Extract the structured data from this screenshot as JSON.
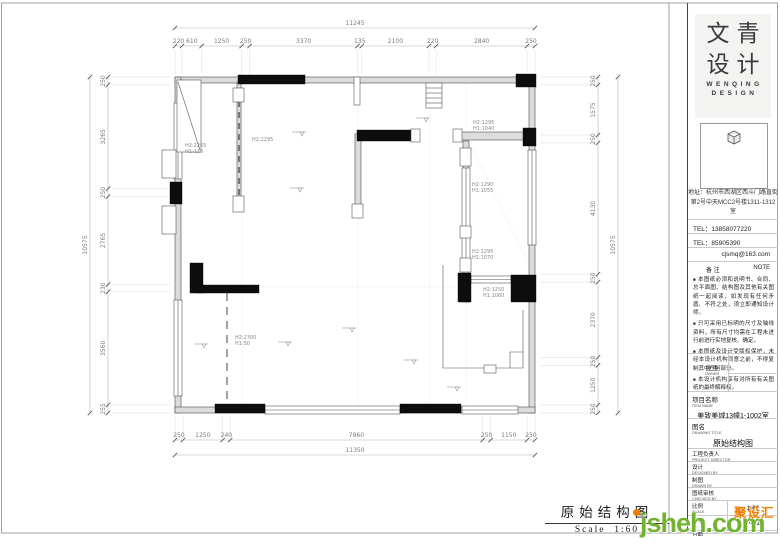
{
  "logo": {
    "line1": "文青",
    "line2": "设计",
    "sub1": "WENQING",
    "sub2": "DESIGN"
  },
  "contact": {
    "address_line1": "地址：杭州市西湖区西斗门路直街",
    "address_line2": "第2号中天MCC2号楼1311-1312室",
    "tel1": "TEL：13858077220",
    "tel2": "TEL：85905390",
    "email": "cjsmq@163.com"
  },
  "note": {
    "label": "备  注",
    "label_en": "NOTE",
    "items": [
      "本图纸必须和说明书、合同、总平面图、结构图及其他有关图纸一起阅读，如发现有任何矛盾、不符之处，须立即通知设计师。",
      "只可采用已标明的尺寸及轴线资料，所有尺寸均需在工程未进行前进行实地复核、确定。",
      "本图纸及设计受版权保护，未经本设计机构同意之前，不得复制其中任何部分。",
      "本设计机构享有对所有有关图纸的最终解释权。"
    ]
  },
  "fields": {
    "owner": {
      "label": "业主",
      "label_en": "OWNER"
    },
    "project": {
      "label": "项目名称",
      "label_en": "ITEM NAME",
      "value": "美致美城13幢1-1002室"
    },
    "drawing": {
      "label": "图名",
      "label_en": "DRAWING TITLE",
      "value": "原始结构图"
    },
    "director": {
      "label": "工程负责人",
      "label_en": "PROJECT DIRECTOR"
    },
    "design": {
      "label": "设计",
      "label_en": "DESIGNED BY"
    },
    "draft": {
      "label": "制图",
      "label_en": "DRAWN BY"
    },
    "check": {
      "label": "图纸审核",
      "label_en": "CHECKED BY"
    },
    "scale": {
      "label": "比例",
      "label_en": "SCALE",
      "value": "1:60"
    },
    "number": {
      "label": "图号",
      "label_en": "No.",
      "value": "P-01"
    },
    "date": {
      "label": "日期",
      "label_en": "DATE"
    }
  },
  "title_block": {
    "title": "原始结构图",
    "scale": "Scale  1:60"
  },
  "watermark": {
    "site": "jsheh.com",
    "brand": "聚设汇",
    "green": "#72b32f",
    "orange": "#f07d00"
  },
  "plan": {
    "dims_top_overall": "11245",
    "dims_top": [
      "220",
      "610",
      "1250",
      "250",
      "3370",
      "135",
      "2100",
      "220",
      "2840",
      "250"
    ],
    "dims_bottom": [
      "250",
      "1250",
      "240",
      "7960",
      "250",
      "1150",
      "250"
    ],
    "dims_bottom_overall": "11350",
    "dims_left": [
      "250",
      "3265",
      "250",
      "2765",
      "230",
      "3560",
      "255"
    ],
    "dims_left_overall": "10575",
    "dims_right": [
      "250",
      "1575",
      "250",
      "4130",
      "250",
      "2370",
      "250",
      "1250",
      "250"
    ],
    "dims_right_overall": "10575",
    "labels": [
      {
        "l1": "H2:2265",
        "l2": "H1:110"
      },
      {
        "l1": "H2:2295",
        "l2": ""
      },
      {
        "l1": "H2:1295",
        "l2": "H1:1040"
      },
      {
        "l1": "H2:1290",
        "l2": "H1:1055"
      },
      {
        "l1": "H2:1295",
        "l2": "H1:1070"
      },
      {
        "l1": "H2:1250",
        "l2": "H1:1060"
      },
      {
        "l1": "H2:2300",
        "l2": "H1:50"
      }
    ]
  }
}
